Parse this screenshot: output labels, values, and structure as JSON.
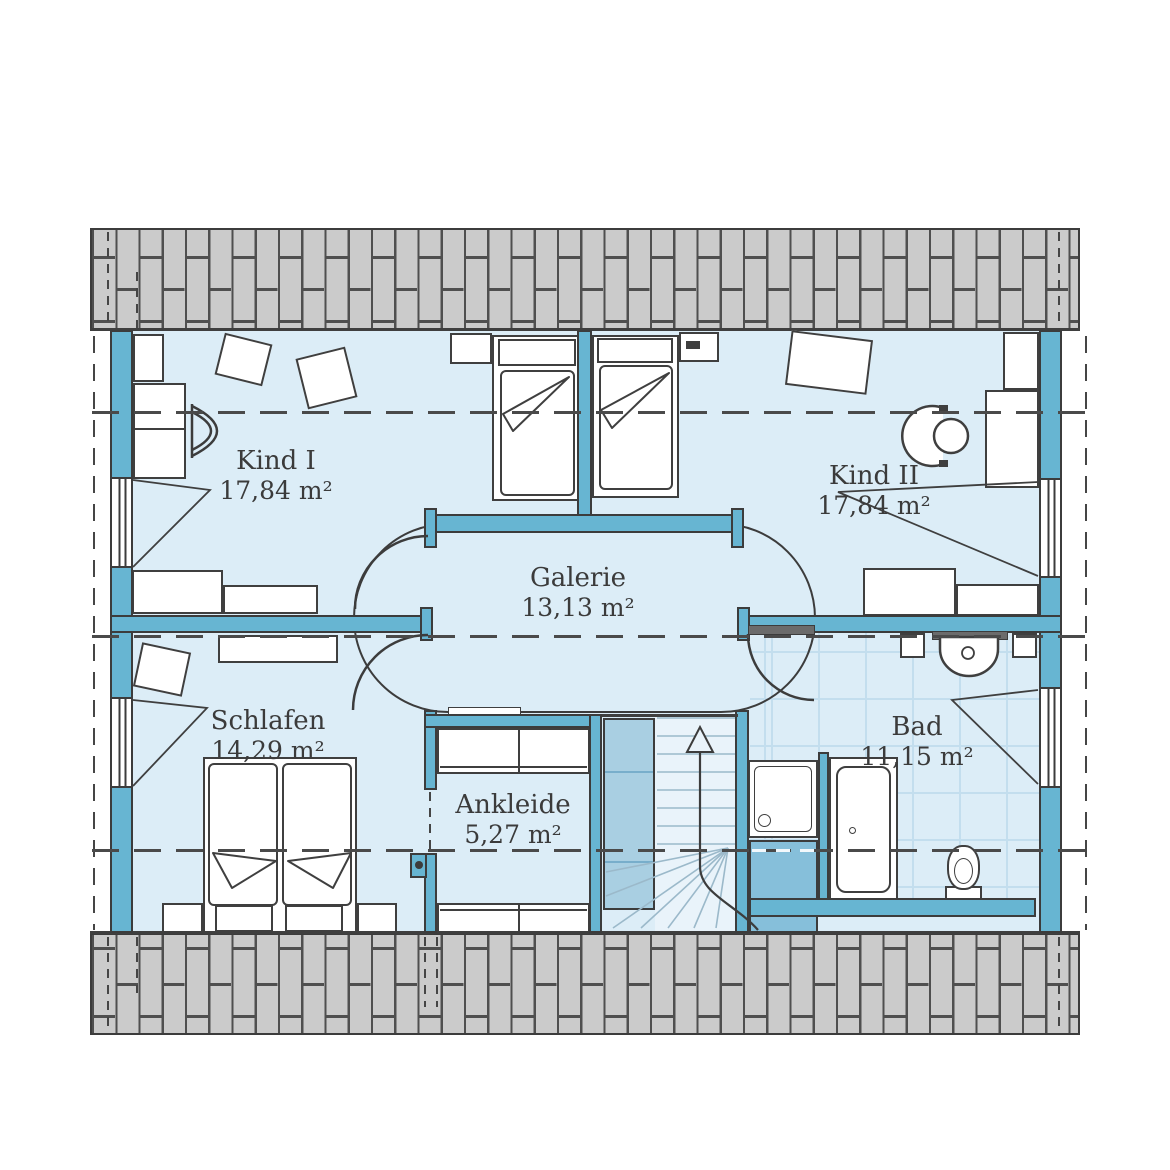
{
  "plan": {
    "title": "Dachgeschoss Grundriss",
    "rooms": [
      {
        "id": "kind1",
        "name": "Kind I",
        "area": "17,84 m²"
      },
      {
        "id": "kind2",
        "name": "Kind II",
        "area": "17,84 m²"
      },
      {
        "id": "galerie",
        "name": "Galerie",
        "area": "13,13 m²"
      },
      {
        "id": "schlafen",
        "name": "Schlafen",
        "area": "14,29 m²"
      },
      {
        "id": "ankleide",
        "name": "Ankleide",
        "area": "5,27 m²"
      },
      {
        "id": "bad",
        "name": "Bad",
        "area": "11,15 m²"
      }
    ],
    "colors": {
      "wall_teal": "#67b5d2",
      "floor_light_blue": "#dcedf7",
      "roof_gray": "#cbcbcb",
      "outline_dark": "#3c3c3c",
      "tile_line": "#c3deee",
      "stair_void_blue": "#a9cfe2"
    }
  }
}
